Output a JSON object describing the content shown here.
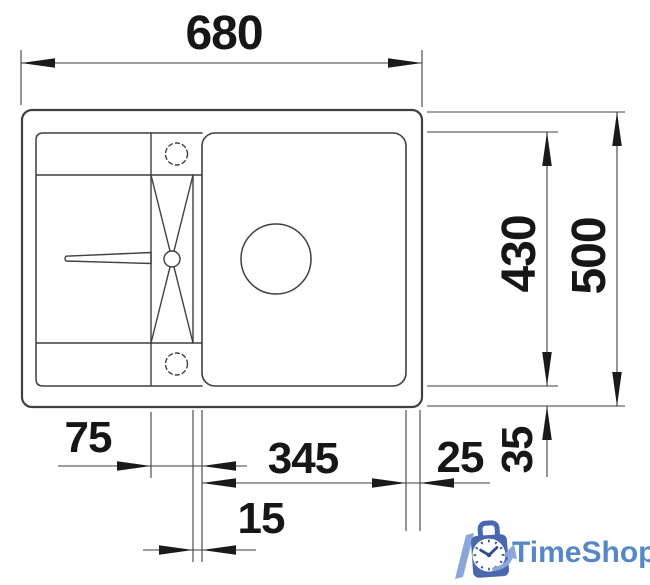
{
  "diagram": {
    "name": "kitchen-sink-technical-drawing",
    "dimensions": {
      "overall_width": "680",
      "bowl_depth": "430",
      "overall_depth": "500",
      "ledge_width": "75",
      "bowl_width": "345",
      "right_margin": "25",
      "front_margin": "35",
      "divider_gap": "15"
    },
    "line_color": "#3f3f3f",
    "arrow_color": "#1a1a1a",
    "label_color": "#161616",
    "background_color": "#ffffff"
  },
  "logo": {
    "text": "TimeShop",
    "text_color": "#5688c8",
    "bag_color": "#4a68b0",
    "accent_color": "#8ba6d8",
    "clock_face_color": "#ffffff",
    "hands_color": "#2e4d8f"
  }
}
